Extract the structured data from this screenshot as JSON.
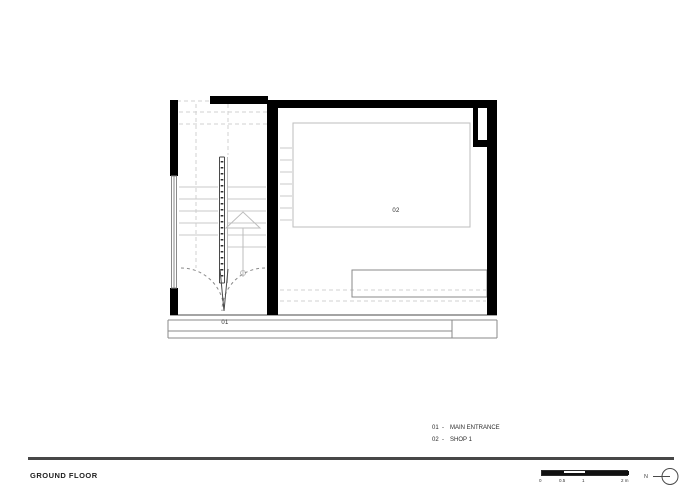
{
  "sheet": {
    "title": "GROUND FLOOR"
  },
  "plan": {
    "room_labels": [
      {
        "id": "01",
        "label": "01"
      },
      {
        "id": "02",
        "label": "02"
      }
    ]
  },
  "legend": {
    "items": [
      {
        "code": "01",
        "separator": "-",
        "name": "MAIN ENTRANCE"
      },
      {
        "code": "02",
        "separator": "-",
        "name": "SHOP 1"
      }
    ]
  },
  "scale_bar": {
    "ticks": [
      "0",
      "0.5",
      "1",
      "2 m"
    ]
  },
  "north_arrow": {
    "label": "N"
  },
  "colors": {
    "paper": "#ffffff",
    "wall": "#000000",
    "thin_line": "#4a4a4a",
    "medium_line": "#8a8a8a",
    "light_line": "#bdbdbd",
    "step_line": "#c9c9c9",
    "dashed_line": "#d2d2d2",
    "door_arc": "#8a8a8a",
    "text": "#2b2b2b",
    "rule": "#474747"
  }
}
